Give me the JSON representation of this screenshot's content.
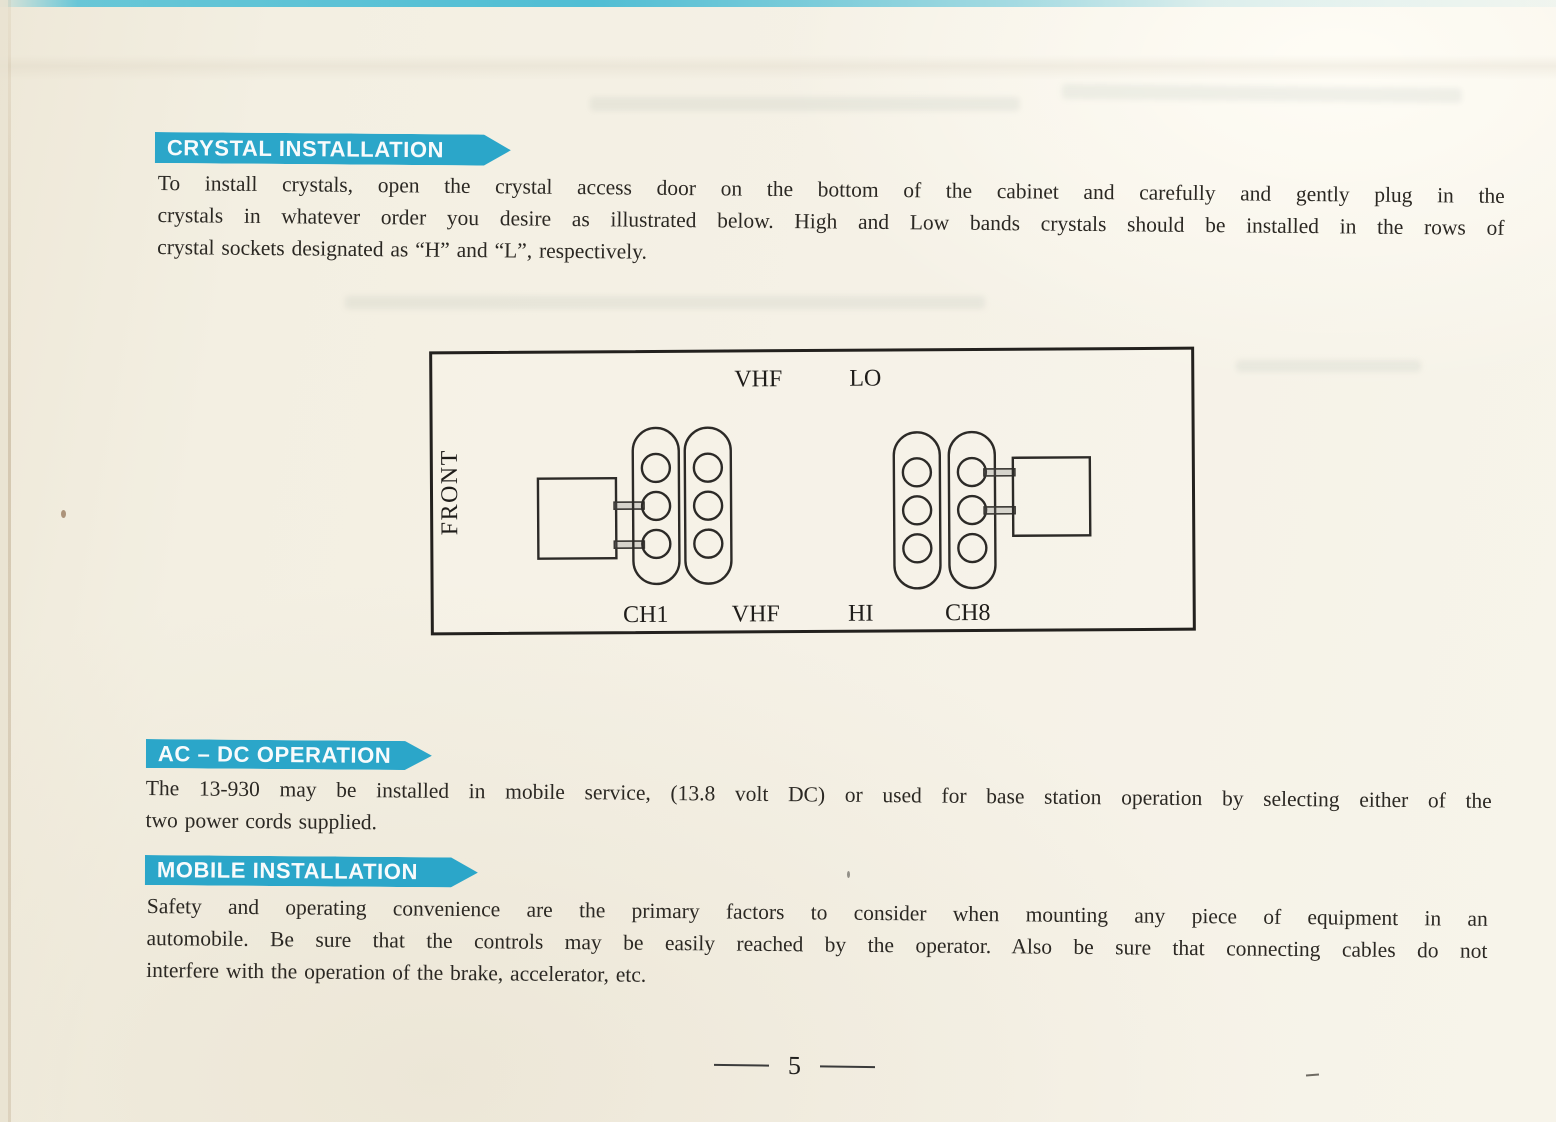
{
  "colors": {
    "banner_cyan": "#2ba6c9",
    "paper": "#f4f0e4",
    "ink": "#2b2823"
  },
  "sections": {
    "crystal": {
      "banner": "CRYSTAL INSTALLATION",
      "lines": [
        "To install crystals, open the crystal access door on the bottom of the cabinet and carefully and gently plug in the",
        "crystals in whatever order you desire as illustrated below. High and Low bands crystals should be installed in the rows of",
        "crystal sockets designated as “H” and “L”, respectively."
      ]
    },
    "acdc": {
      "banner": "AC – DC OPERATION",
      "lines": [
        "The 13-930 may be installed in mobile service, (13.8 volt DC) or used for base station operation by selecting either of the",
        "two power cords supplied."
      ]
    },
    "mobile": {
      "banner": "MOBILE INSTALLATION",
      "lines": [
        "Safety and operating convenience are the primary factors to consider when mounting any piece of equipment in an",
        "automobile. Be sure that the controls may be easily reached by the operator. Also be sure that connecting cables do not",
        "interfere with the operation of the brake, accelerator, etc."
      ]
    }
  },
  "diagram": {
    "front_label": "FRONT",
    "top_labels": {
      "vhf": "VHF",
      "lo": "LO"
    },
    "bottom_labels": {
      "ch1": "CH1",
      "vhf": "VHF",
      "hi": "HI",
      "ch8": "CH8"
    }
  },
  "footer": {
    "page_number": "5"
  }
}
